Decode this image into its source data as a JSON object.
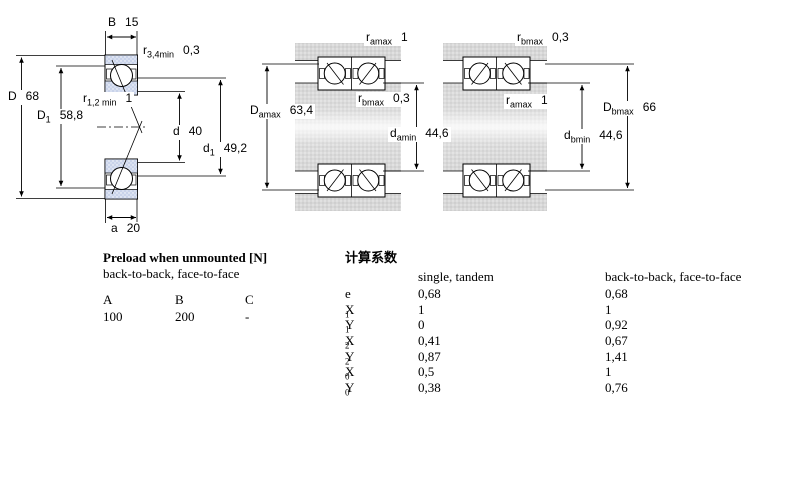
{
  "colors": {
    "ring_fill": "#c9d3ea",
    "housing_fill": "#d7d7d7",
    "line": "#000000",
    "background": "#ffffff"
  },
  "dims": {
    "B": {
      "pre": "B",
      "sub": "",
      "value": "15"
    },
    "r34": {
      "pre": "r",
      "sub": "3,4min",
      "value": "0,3"
    },
    "D": {
      "pre": "D",
      "sub": "",
      "value": "68"
    },
    "D1": {
      "pre": "D",
      "sub": "1",
      "value": "58,8"
    },
    "r12": {
      "pre": "r",
      "sub": "1,2 min",
      "value": "1"
    },
    "d": {
      "pre": "d",
      "sub": "",
      "value": "40"
    },
    "d1": {
      "pre": "d",
      "sub": "1",
      "value": "49,2"
    },
    "a": {
      "pre": "a",
      "sub": "",
      "value": "20"
    },
    "ramax_c": {
      "pre": "r",
      "sub": "amax",
      "value": "1"
    },
    "rbmax_c": {
      "pre": "r",
      "sub": "bmax",
      "value": "0,3"
    },
    "Damax": {
      "pre": "D",
      "sub": "amax",
      "value": "63,4"
    },
    "damin": {
      "pre": "d",
      "sub": "amin",
      "value": "44,6"
    },
    "rbmax_r": {
      "pre": "r",
      "sub": "bmax",
      "value": "0,3"
    },
    "ramax_r": {
      "pre": "r",
      "sub": "amax",
      "value": "1"
    },
    "Dbmax": {
      "pre": "D",
      "sub": "bmax",
      "value": "66"
    },
    "dbmin": {
      "pre": "d",
      "sub": "bmin",
      "value": "44,6"
    }
  },
  "preload": {
    "title": "Preload when unmounted [N]",
    "subtitle": "back-to-back, face-to-face",
    "columns": [
      "A",
      "B",
      "C"
    ],
    "values": [
      "100",
      "200",
      "-"
    ]
  },
  "factors": {
    "title": "计算系数",
    "col_single": "single, tandem",
    "col_btb": "back-to-back, face-to-face",
    "rows": [
      {
        "label": "e",
        "sub": "",
        "single": "0,68",
        "btb": "0,68"
      },
      {
        "label": "X",
        "sub": "1",
        "single": "1",
        "btb": "1"
      },
      {
        "label": "Y",
        "sub": "1",
        "single": "0",
        "btb": "0,92"
      },
      {
        "label": "X",
        "sub": "2",
        "single": "0,41",
        "btb": "0,67"
      },
      {
        "label": "Y",
        "sub": "2",
        "single": "0,87",
        "btb": "1,41"
      },
      {
        "label": "X",
        "sub": "0",
        "single": "0,5",
        "btb": "1"
      },
      {
        "label": "Y",
        "sub": "0",
        "single": "0,38",
        "btb": "0,76"
      }
    ]
  }
}
